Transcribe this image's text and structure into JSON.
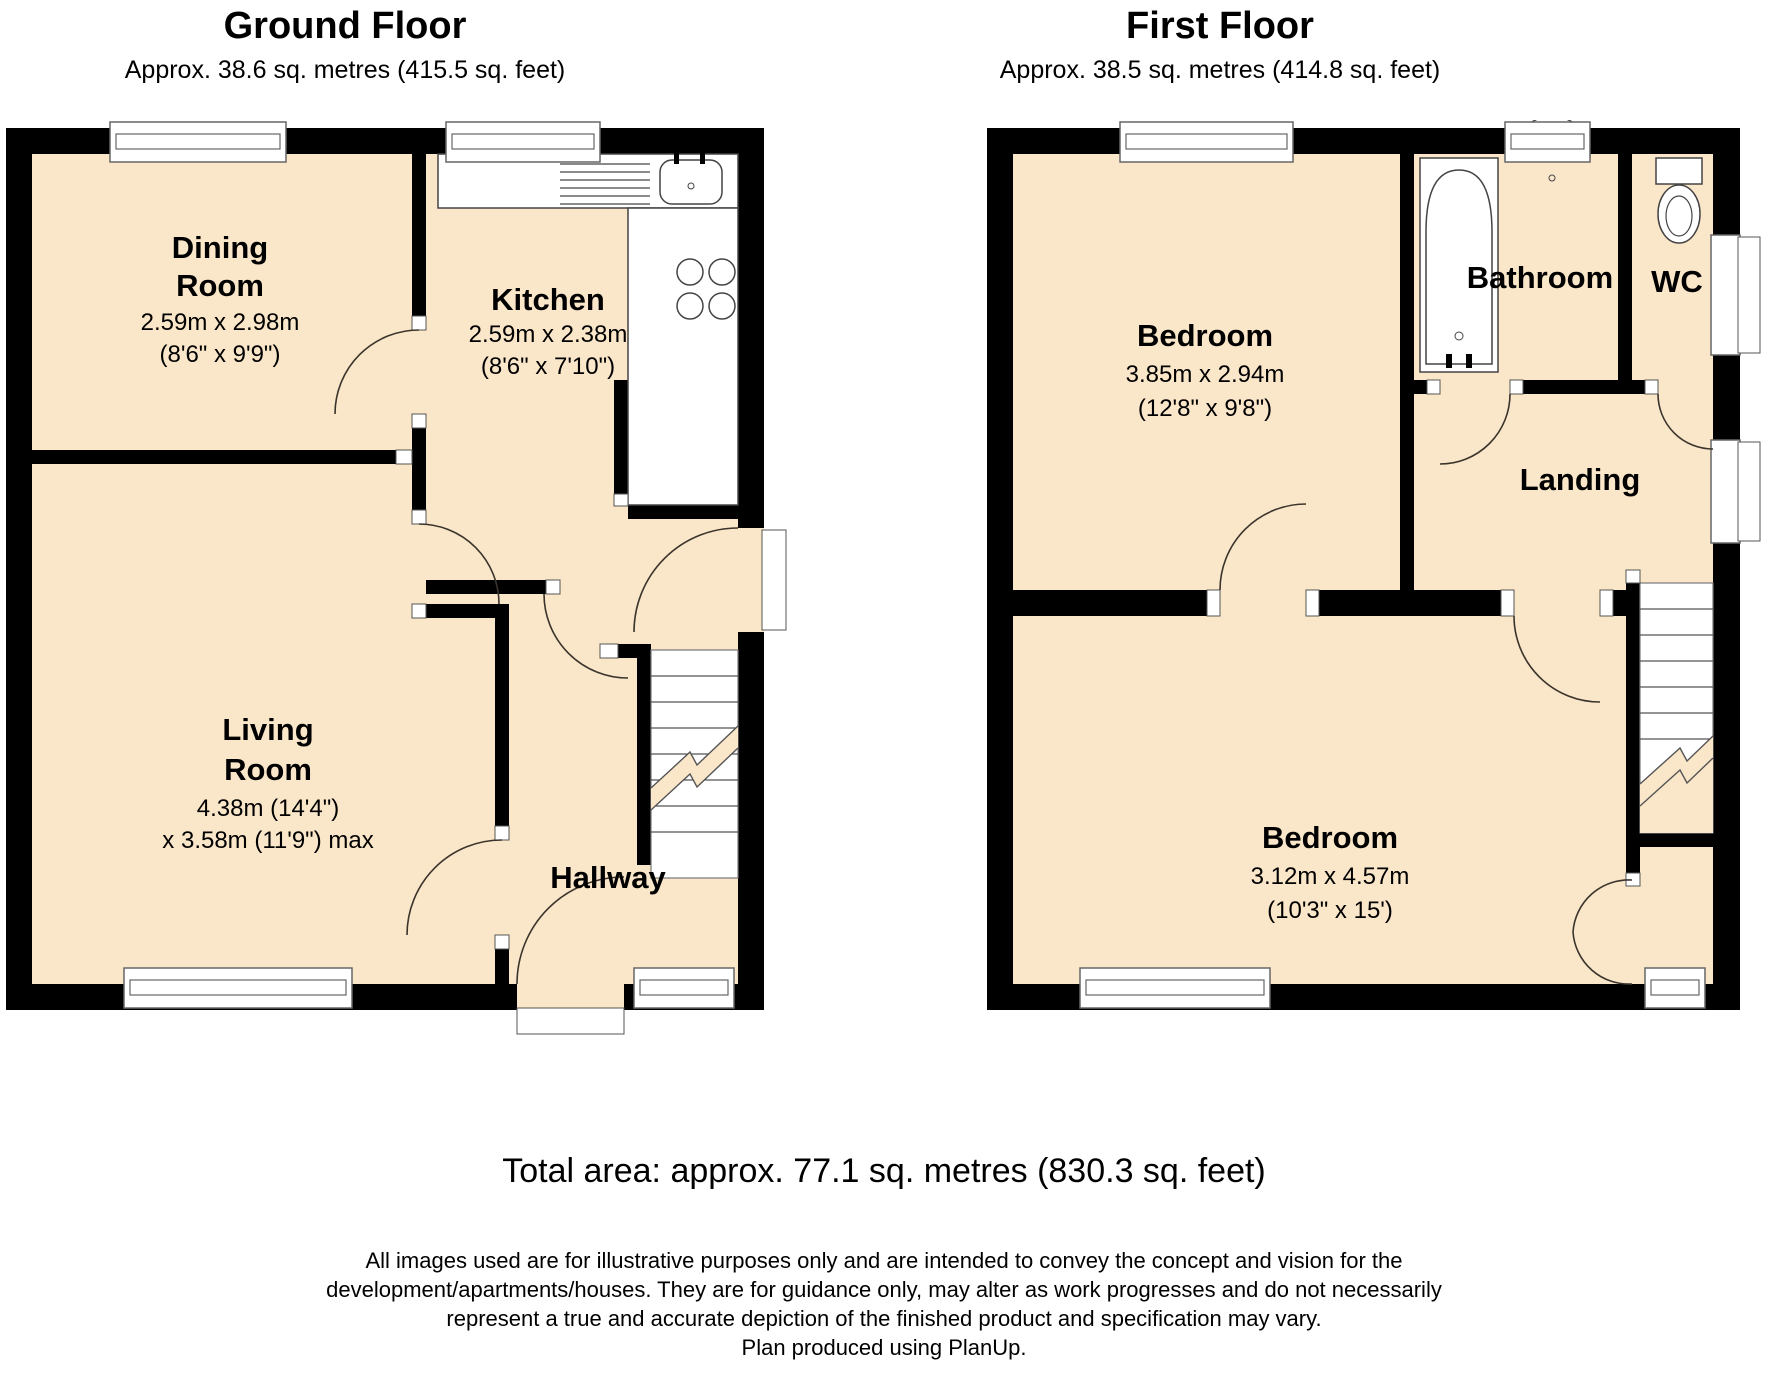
{
  "colors": {
    "room_fill": "#FAE6C8",
    "wall": "#000000"
  },
  "ground_floor": {
    "title": "Ground Floor",
    "subtitle": "Approx. 38.6 sq. metres (415.5 sq. feet)",
    "rooms": {
      "dining": {
        "name_line1": "Dining",
        "name_line2": "Room",
        "dims_metric": "2.59m x 2.98m",
        "dims_imperial": "(8'6\" x 9'9\")"
      },
      "kitchen": {
        "name": "Kitchen",
        "dims_metric": "2.59m x 2.38m",
        "dims_imperial": "(8'6\" x 7'10\")"
      },
      "living": {
        "name_line1": "Living",
        "name_line2": "Room",
        "dims_line1": "4.38m (14'4\")",
        "dims_line2": "x 3.58m (11'9\") max"
      },
      "hallway": {
        "name": "Hallway"
      }
    }
  },
  "first_floor": {
    "title": "First Floor",
    "subtitle": "Approx. 38.5 sq. metres (414.8 sq. feet)",
    "rooms": {
      "bedroom1": {
        "name": "Bedroom",
        "dims_metric": "3.85m x 2.94m",
        "dims_imperial": "(12'8\" x 9'8\")"
      },
      "bathroom": {
        "name": "Bathroom"
      },
      "wc": {
        "name": "WC"
      },
      "landing": {
        "name": "Landing"
      },
      "bedroom2": {
        "name": "Bedroom",
        "dims_metric": "3.12m x 4.57m",
        "dims_imperial": "(10'3\" x 15')"
      }
    }
  },
  "footer": {
    "total_area": "Total area: approx. 77.1 sq. metres (830.3 sq. feet)",
    "disclaimer_line1": "All images used are for illustrative purposes only and are intended to convey the concept and vision for the",
    "disclaimer_line2": "development/apartments/houses. They are for guidance only, may alter as work progresses and do not necessarily",
    "disclaimer_line3": "represent a true and accurate depiction of the finished product and specification may vary.",
    "disclaimer_line4": "Plan produced using PlanUp."
  }
}
